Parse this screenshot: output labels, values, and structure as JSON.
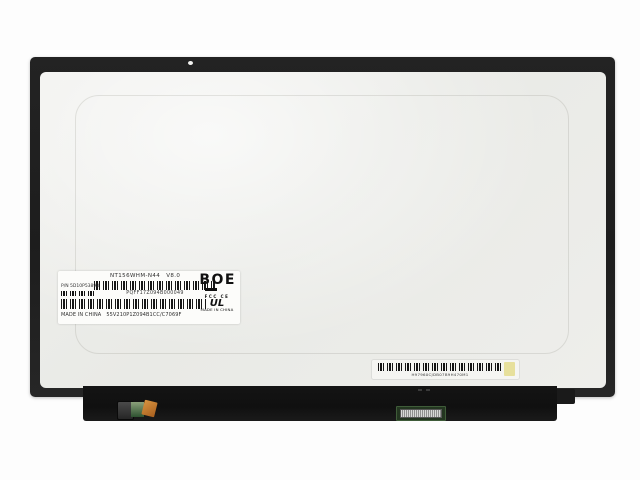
{
  "panel": {
    "label": {
      "model": "NT156WHM-N44",
      "version": "V8.0",
      "barcode1_text": "PQFF17Z094B000049",
      "pn_label": "P/N",
      "pn_value": "5D10P53898",
      "origin": "MADE IN CHINA",
      "serial": "55V210P1Z094B1CC/C7069F",
      "brand": "BOE",
      "marks": {
        "fcc": "FCC",
        "ce": "CE",
        "ul": "UL",
        "origin_small": "MADE IN CHINA"
      }
    },
    "sticker": {
      "code": "H97960CJDB07B9H470M1"
    }
  }
}
